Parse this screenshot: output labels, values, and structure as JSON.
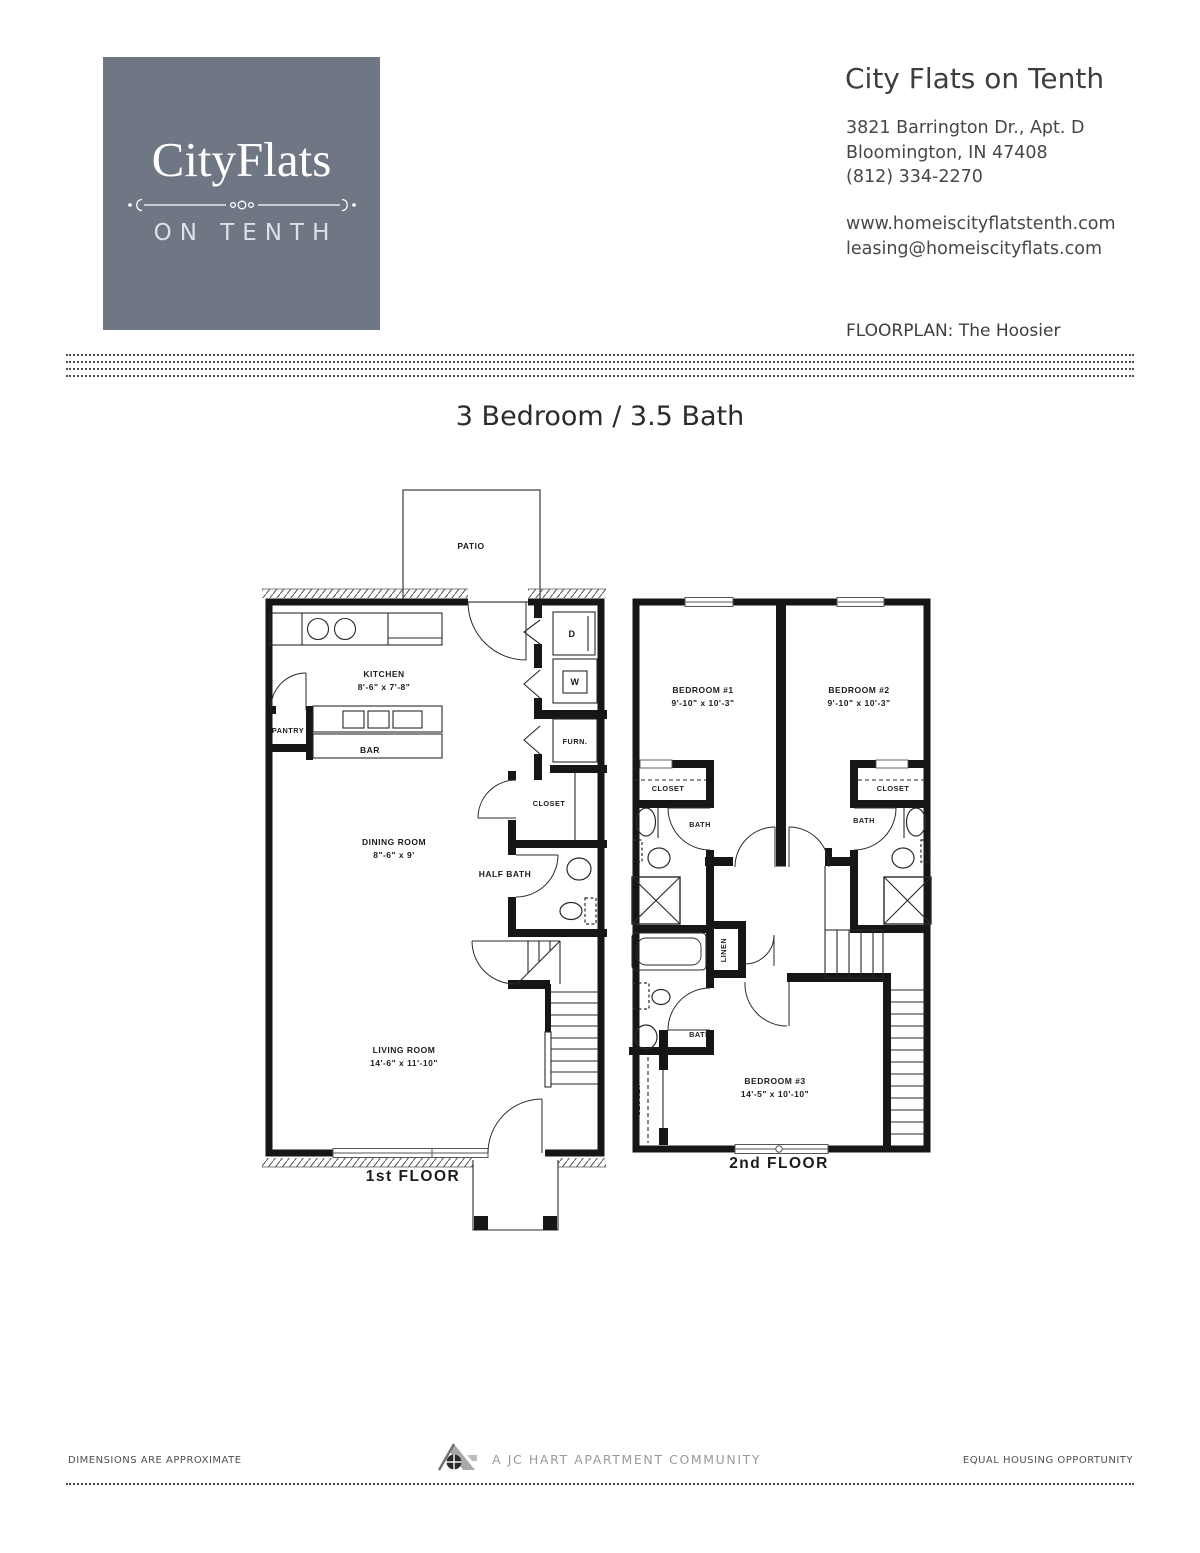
{
  "logo": {
    "brand": "CityFlats",
    "sub": "ON TENTH"
  },
  "header": {
    "title": "City Flats on Tenth",
    "address_line1": "3821 Barrington Dr., Apt. D",
    "address_line2": "Bloomington, IN 47408",
    "phone": "(812) 334-2270",
    "website": "www.homeiscityflatstenth.com",
    "email": "leasing@homeiscityflats.com",
    "floorplan_label": "FLOORPLAN: The Hoosier"
  },
  "plan_title": "3 Bedroom / 3.5 Bath",
  "floor1": {
    "name": "1st FLOOR",
    "patio": "PATIO",
    "kitchen": "KITCHEN",
    "kitchen_dims": "8'-6\" x 7'-8\"",
    "pantry": "PANTRY",
    "bar": "BAR",
    "dryer": "D",
    "washer": "W",
    "furnace": "FURN.",
    "closet": "CLOSET",
    "dining": "DINING ROOM",
    "dining_dims": "8\"-6\" x 9'",
    "half_bath": "HALF BATH",
    "living": "LIVING ROOM",
    "living_dims": "14'-6\" x 11'-10\""
  },
  "floor2": {
    "name": "2nd FLOOR",
    "bedroom1": "BEDROOM #1",
    "bedroom1_dims": "9'-10\" x 10'-3\"",
    "bedroom2": "BEDROOM #2",
    "bedroom2_dims": "9'-10\" x 10'-3\"",
    "bedroom3": "BEDROOM #3",
    "bedroom3_dims": "14'-5\" x 10'-10\"",
    "closet_left": "CLOSET",
    "closet_right": "CLOSET",
    "closet_br3": "CLOSET",
    "bath_left": "BATH",
    "bath_right": "BATH",
    "bath_lower": "BATH",
    "linen": "LINEN"
  },
  "footer": {
    "left": "DIMENSIONS ARE APPROXIMATE",
    "center": "A JC HART APARTMENT COMMUNITY",
    "right": "EQUAL HOUSING OPPORTUNITY"
  },
  "colors": {
    "logo_bg": "#6f7785",
    "ink": "#161616"
  }
}
